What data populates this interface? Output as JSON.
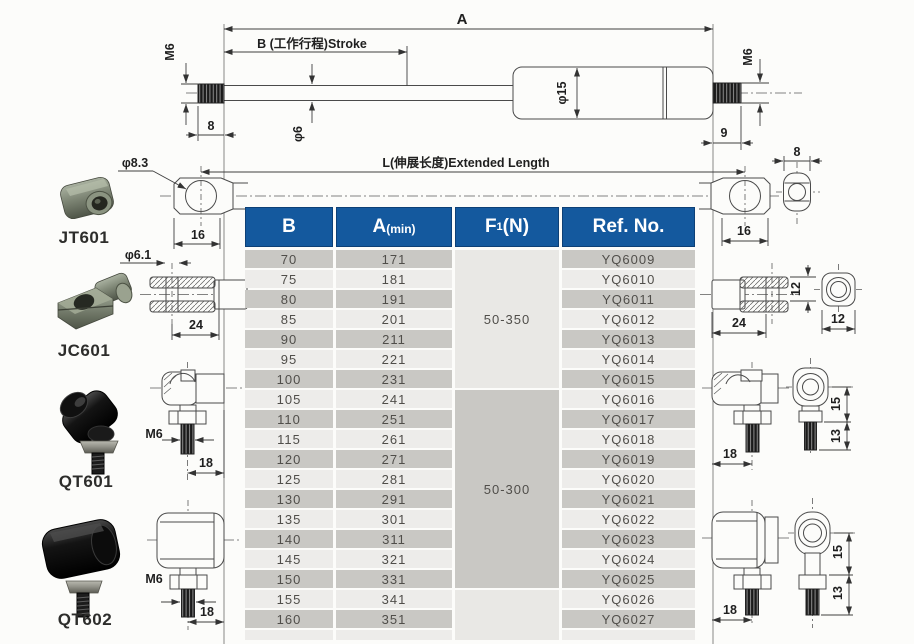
{
  "diagram": {
    "dim_a": "A",
    "stroke_label": "B (工作行程)Stroke",
    "extended_label": "L(伸展长度)Extended Length",
    "rod_thread": "M6",
    "body_thread": "M6",
    "rod_dia": "φ6",
    "tube_dia": "φ15",
    "rod_thread_len": "8",
    "body_thread_len": "9",
    "eyelet_width_left": "16",
    "eyelet_width_right": "16",
    "eyelet_end_width": "8",
    "eyelet_hole_dia": "φ8.3",
    "clevis_hole_dia": "φ6.1",
    "clevis_len_left": "24",
    "clevis_len_right": "24",
    "clevis_fork_height": "12",
    "clevis_end_width": "12",
    "qt601_thread": "M6",
    "qt601_offset": "18",
    "qt602_thread": "M6",
    "qt602_offset": "18",
    "qt601_right_offset": "18",
    "qt601_height_upper": "15",
    "qt601_height_lower": "13",
    "qt602_right_offset": "18",
    "qt602_height_upper": "15",
    "qt602_height_lower": "13"
  },
  "parts": {
    "jt601": "JT601",
    "jc601": "JC601",
    "qt601": "QT601",
    "qt602": "QT602"
  },
  "table": {
    "headers": [
      {
        "text": "B"
      },
      {
        "text": "A",
        "small": "(min)"
      },
      {
        "text": "F",
        "sub": "1",
        "tail": "(N)"
      },
      {
        "text": "Ref. No."
      }
    ],
    "rows": [
      {
        "b": "70",
        "a": "171",
        "ref": "YQ6009"
      },
      {
        "b": "75",
        "a": "181",
        "ref": "YQ6010"
      },
      {
        "b": "80",
        "a": "191",
        "ref": "YQ6011"
      },
      {
        "b": "85",
        "a": "201",
        "ref": "YQ6012"
      },
      {
        "b": "90",
        "a": "211",
        "ref": "YQ6013"
      },
      {
        "b": "95",
        "a": "221",
        "ref": "YQ6014"
      },
      {
        "b": "100",
        "a": "231",
        "ref": "YQ6015"
      },
      {
        "b": "105",
        "a": "241",
        "ref": "YQ6016"
      },
      {
        "b": "110",
        "a": "251",
        "ref": "YQ6017"
      },
      {
        "b": "115",
        "a": "261",
        "ref": "YQ6018"
      },
      {
        "b": "120",
        "a": "271",
        "ref": "YQ6019"
      },
      {
        "b": "125",
        "a": "281",
        "ref": "YQ6020"
      },
      {
        "b": "130",
        "a": "291",
        "ref": "YQ6021"
      },
      {
        "b": "135",
        "a": "301",
        "ref": "YQ6022"
      },
      {
        "b": "140",
        "a": "311",
        "ref": "YQ6023"
      },
      {
        "b": "145",
        "a": "321",
        "ref": "YQ6024"
      },
      {
        "b": "150",
        "a": "331",
        "ref": "YQ6025"
      },
      {
        "b": "155",
        "a": "341",
        "ref": "YQ6026"
      },
      {
        "b": "160",
        "a": "351",
        "ref": "YQ6027"
      }
    ],
    "force_groups": [
      {
        "label": "50-350",
        "start": 0,
        "span": 7,
        "shade": "light"
      },
      {
        "label": "50-300",
        "start": 7,
        "span": 10,
        "shade": "dark"
      },
      {
        "label": "",
        "start": 17,
        "span": 2,
        "shade": "light"
      }
    ]
  },
  "colors": {
    "header_blue": "#14599E",
    "row_dark": "#c9c8c4",
    "row_light": "#edecea",
    "group_light": "#e9e8e5",
    "line": "#4a4a4a"
  }
}
